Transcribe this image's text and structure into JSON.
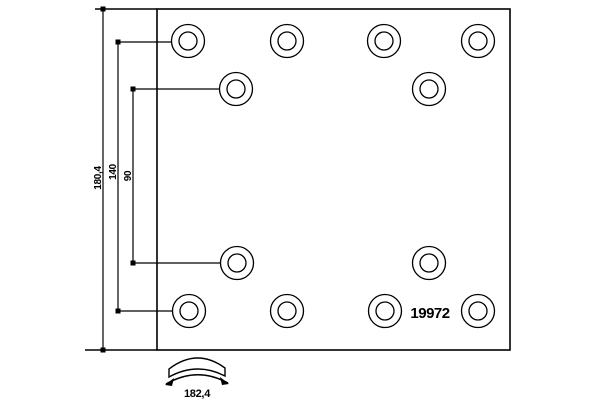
{
  "diagram": {
    "part_number": "19972",
    "dim_total_height": "180,4",
    "dim_hole_span_outer": "140",
    "dim_hole_span_inner": "90",
    "dim_arc_width": "182,4",
    "line_color": "#000000",
    "background_color": "#ffffff",
    "holes": {
      "outer_r": 16.5,
      "inner_r": 9,
      "centers": [
        {
          "x": 188,
          "y": 41
        },
        {
          "x": 287,
          "y": 41
        },
        {
          "x": 384,
          "y": 41
        },
        {
          "x": 478,
          "y": 41
        },
        {
          "x": 236,
          "y": 89
        },
        {
          "x": 429,
          "y": 89
        },
        {
          "x": 237,
          "y": 263
        },
        {
          "x": 429,
          "y": 263
        },
        {
          "x": 189,
          "y": 311
        },
        {
          "x": 287,
          "y": 311
        },
        {
          "x": 385,
          "y": 311
        },
        {
          "x": 478,
          "y": 311
        }
      ]
    }
  }
}
